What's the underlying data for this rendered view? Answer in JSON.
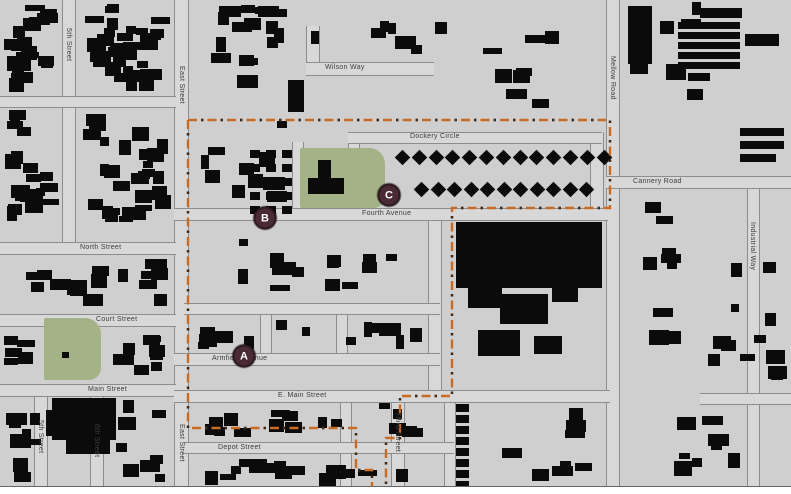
{
  "map": {
    "colors": {
      "background": "#cfcfcf",
      "road_fill": "#d8d8d8",
      "road_edge": "#8d8d8d",
      "building": "#0b0b0b",
      "park": "#a3b287",
      "boundary": "#c76b25",
      "boundary_dot": "#3a2a1a",
      "marker_fill": "#4a2a35",
      "marker_text": "#ffffff"
    },
    "markers": [
      {
        "label": "A",
        "x": 244,
        "y": 356
      },
      {
        "label": "B",
        "x": 265,
        "y": 218
      },
      {
        "label": "C",
        "x": 389,
        "y": 195
      }
    ],
    "street_labels": [
      {
        "name": "Wilson Way",
        "orient": "h",
        "x": 325,
        "y": 64
      },
      {
        "name": "Dockery Circle",
        "orient": "h",
        "x": 410,
        "y": 133
      },
      {
        "name": "Cannery Road",
        "orient": "h",
        "x": 633,
        "y": 178
      },
      {
        "name": "Fourth Avenue",
        "orient": "h",
        "x": 362,
        "y": 210
      },
      {
        "name": "North Street",
        "orient": "h",
        "x": 80,
        "y": 244
      },
      {
        "name": "Court Street",
        "orient": "h",
        "x": 96,
        "y": 316
      },
      {
        "name": "Main Street",
        "orient": "h",
        "x": 88,
        "y": 386
      },
      {
        "name": "E. Main Street",
        "orient": "h",
        "x": 278,
        "y": 392
      },
      {
        "name": "Armfield Avenue",
        "orient": "h",
        "x": 212,
        "y": 355
      },
      {
        "name": "Depot Street",
        "orient": "h",
        "x": 218,
        "y": 444
      },
      {
        "name": "5th Street",
        "orient": "v",
        "x": 64,
        "y": 28
      },
      {
        "name": "East Street",
        "orient": "v",
        "x": 177,
        "y": 66
      },
      {
        "name": "East Street",
        "orient": "v",
        "x": 177,
        "y": 424
      },
      {
        "name": "Mellow Road",
        "orient": "v",
        "x": 608,
        "y": 56
      },
      {
        "name": "Industrial Way",
        "orient": "v",
        "x": 748,
        "y": 222
      },
      {
        "name": "Third Street",
        "orient": "v",
        "x": 393,
        "y": 412
      },
      {
        "name": "5th Street",
        "orient": "v",
        "x": 36,
        "y": 420
      },
      {
        "name": "6th Street",
        "orient": "v",
        "x": 92,
        "y": 424
      }
    ],
    "roads": [
      [
        62,
        0,
        12,
        252,
        "v"
      ],
      [
        174,
        0,
        13,
        487,
        "v"
      ],
      [
        606,
        0,
        12,
        487,
        "v"
      ],
      [
        747,
        186,
        11,
        301,
        "v"
      ],
      [
        391,
        393,
        12,
        94,
        "v"
      ],
      [
        34,
        388,
        12,
        99,
        "v"
      ],
      [
        90,
        388,
        12,
        99,
        "v"
      ],
      [
        428,
        212,
        12,
        183,
        "v"
      ],
      [
        260,
        305,
        10,
        52,
        "v"
      ],
      [
        336,
        305,
        10,
        52,
        "v"
      ],
      [
        340,
        393,
        10,
        94,
        "v"
      ],
      [
        444,
        393,
        10,
        94,
        "v"
      ],
      [
        306,
        26,
        12,
        46,
        "v"
      ],
      [
        348,
        140,
        10,
        72,
        "v"
      ],
      [
        590,
        132,
        12,
        78,
        "v"
      ],
      [
        292,
        142,
        10,
        70,
        "v"
      ],
      [
        0,
        242,
        176,
        11,
        "h"
      ],
      [
        0,
        314,
        176,
        11,
        "h"
      ],
      [
        0,
        384,
        176,
        11,
        "h"
      ],
      [
        174,
        390,
        436,
        11,
        "h"
      ],
      [
        174,
        353,
        266,
        11,
        "h"
      ],
      [
        174,
        208,
        434,
        11,
        "h"
      ],
      [
        606,
        176,
        185,
        11,
        "h"
      ],
      [
        184,
        442,
        270,
        10,
        "h"
      ],
      [
        306,
        62,
        128,
        12,
        "h"
      ],
      [
        348,
        132,
        254,
        10,
        "h"
      ],
      [
        184,
        303,
        256,
        10,
        "h"
      ],
      [
        0,
        96,
        176,
        10,
        "h"
      ],
      [
        700,
        393,
        91,
        10,
        "h"
      ]
    ],
    "parks": [
      {
        "x": 300,
        "y": 148,
        "w": 85,
        "h": 60
      },
      {
        "x": 44,
        "y": 318,
        "w": 57,
        "h": 62
      }
    ],
    "boundary_paths": [
      "M188,120 H610 V208 H452 V396 H400 V438 H386 V487",
      "M188,120 V428 H356 V470 H372 V487"
    ],
    "landmark_rects": [
      [
        456,
        222,
        146,
        66
      ],
      [
        468,
        288,
        34,
        20
      ],
      [
        500,
        294,
        48,
        30
      ],
      [
        552,
        288,
        26,
        14
      ],
      [
        478,
        330,
        42,
        26
      ],
      [
        534,
        336,
        28,
        18
      ],
      [
        52,
        398,
        64,
        42
      ],
      [
        66,
        438,
        44,
        16
      ],
      [
        46,
        410,
        12,
        26
      ],
      [
        628,
        6,
        24,
        58
      ],
      [
        666,
        64,
        20,
        16
      ],
      [
        700,
        8,
        42,
        10
      ],
      [
        745,
        34,
        34,
        12
      ],
      [
        740,
        128,
        44,
        8
      ],
      [
        740,
        141,
        44,
        8
      ],
      [
        740,
        154,
        36,
        8
      ],
      [
        288,
        80,
        16,
        32
      ],
      [
        318,
        160,
        13,
        22
      ],
      [
        308,
        178,
        36,
        16
      ],
      [
        62,
        352,
        7,
        6
      ]
    ],
    "diamond_rows": [
      {
        "x0": 397,
        "y": 152,
        "n": 13,
        "step": 16.8
      },
      {
        "x0": 416,
        "y": 184,
        "n": 11,
        "step": 16.5
      }
    ],
    "diamond_size": 11,
    "stripe_building": {
      "x": 678,
      "y": 22,
      "w": 62,
      "n": 5,
      "step": 10,
      "h": 7
    },
    "column_building": {
      "x": 456,
      "y": 404,
      "n": 8,
      "step": 11,
      "w": 13,
      "h": 8
    },
    "rowhouses": {
      "cols": [
        250,
        266,
        282
      ],
      "rows": [
        150,
        164,
        178,
        192,
        206
      ],
      "w": 10,
      "h": 8
    },
    "building_blocks": [
      [
        4,
        2,
        56,
        90,
        22
      ],
      [
        80,
        2,
        92,
        90,
        30
      ],
      [
        4,
        110,
        56,
        125,
        20
      ],
      [
        80,
        110,
        92,
        125,
        28
      ],
      [
        196,
        2,
        104,
        90,
        16
      ],
      [
        310,
        2,
        150,
        55,
        7
      ],
      [
        196,
        118,
        92,
        86,
        10
      ],
      [
        470,
        30,
        115,
        80,
        8
      ],
      [
        625,
        2,
        115,
        108,
        8
      ],
      [
        4,
        258,
        166,
        52,
        15
      ],
      [
        4,
        332,
        36,
        44,
        5
      ],
      [
        106,
        332,
        62,
        44,
        8
      ],
      [
        230,
        232,
        196,
        64,
        14
      ],
      [
        196,
        318,
        228,
        32,
        13
      ],
      [
        190,
        402,
        244,
        36,
        16
      ],
      [
        190,
        458,
        248,
        28,
        15
      ],
      [
        474,
        402,
        130,
        85,
        8
      ],
      [
        625,
        192,
        118,
        125,
        9
      ],
      [
        625,
        330,
        160,
        58,
        7
      ],
      [
        625,
        412,
        118,
        72,
        8
      ],
      [
        762,
        200,
        26,
        180,
        5
      ],
      [
        108,
        398,
        60,
        86,
        8
      ],
      [
        2,
        398,
        42,
        86,
        9
      ]
    ]
  }
}
